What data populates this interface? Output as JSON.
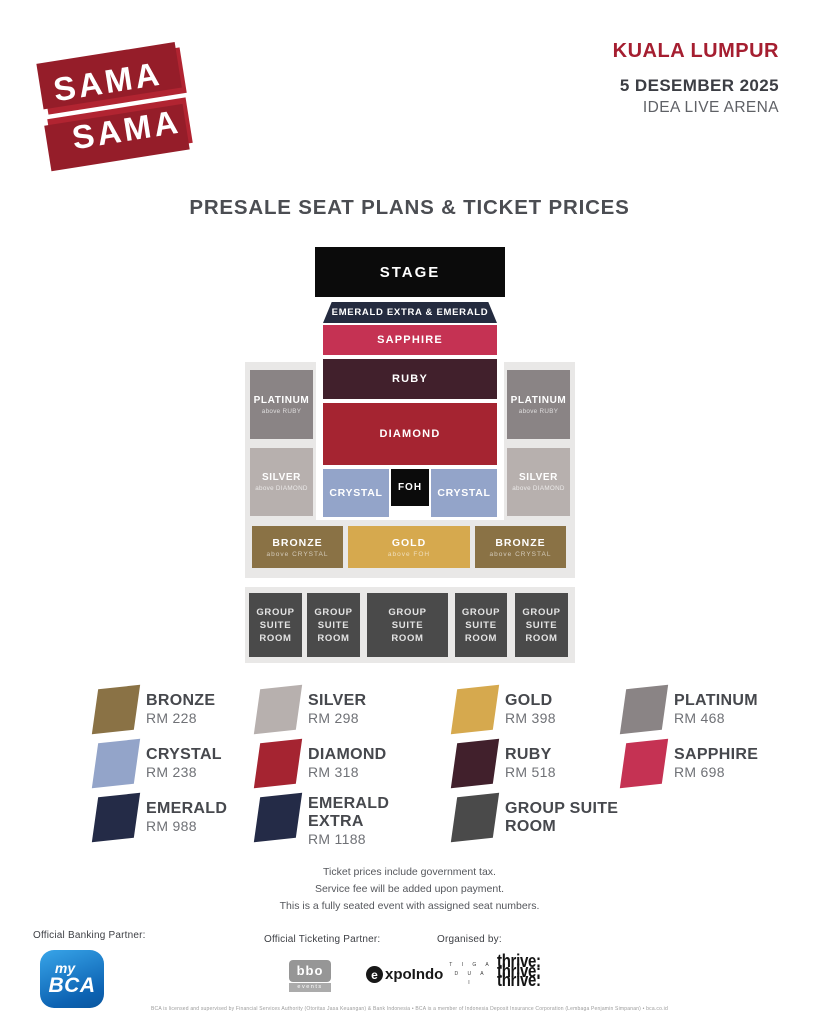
{
  "header": {
    "logo": {
      "line1": "SAMA",
      "line2": "SAMA",
      "color": "#b12431"
    },
    "city": "KUALA LUMPUR",
    "city_color": "#a51e30",
    "date": "5 DESEMBER 2025",
    "venue": "IDEA LIVE ARENA"
  },
  "title": "PRESALE SEAT PLANS & TICKET PRICES",
  "seatmap": {
    "stage": {
      "label": "STAGE",
      "color": "#0b0b0b"
    },
    "emerald_band": {
      "label": "EMERALD EXTRA & EMERALD",
      "color": "#242b3f"
    },
    "sapphire": {
      "label": "SAPPHIRE",
      "color": "#c53253"
    },
    "ruby": {
      "label": "RUBY",
      "color": "#41202c"
    },
    "diamond": {
      "label": "DIAMOND",
      "color": "#a52431"
    },
    "crystal": {
      "label": "CRYSTAL",
      "color": "#93a4c9"
    },
    "foh": {
      "label": "FOH",
      "color": "#0b0b0b"
    },
    "platinum": {
      "label": "PLATINUM",
      "sublabel": "above RUBY",
      "color": "#8a8485"
    },
    "silver": {
      "label": "SILVER",
      "sublabel": "above DIAMOND",
      "color": "#b7b0ae"
    },
    "bronze": {
      "label": "BRONZE",
      "sublabel": "above CRYSTAL",
      "color": "#8a7245"
    },
    "gold": {
      "label": "GOLD",
      "sublabel": "above FOH",
      "color": "#d6a94e"
    },
    "group_suite": {
      "label": "GROUP\nSUITE\nROOM",
      "color": "#4a4a4a"
    }
  },
  "legend": {
    "items": [
      {
        "name": "BRONZE",
        "price": "RM 228",
        "color": "#8a7245"
      },
      {
        "name": "SILVER",
        "price": "RM 298",
        "color": "#b7b0ae"
      },
      {
        "name": "GOLD",
        "price": "RM 398",
        "color": "#d6a94e"
      },
      {
        "name": "PLATINUM",
        "price": "RM 468",
        "color": "#8a8485"
      },
      {
        "name": "CRYSTAL",
        "price": "RM 238",
        "color": "#93a4c9"
      },
      {
        "name": "DIAMOND",
        "price": "RM 318",
        "color": "#a52431"
      },
      {
        "name": "RUBY",
        "price": "RM 518",
        "color": "#41202c"
      },
      {
        "name": "SAPPHIRE",
        "price": "RM 698",
        "color": "#c53253"
      },
      {
        "name": "EMERALD",
        "price": "RM 988",
        "color": "#242b47"
      },
      {
        "name": "EMERALD EXTRA",
        "price": "RM 1188",
        "color": "#242b47"
      },
      {
        "name": "GROUP SUITE ROOM",
        "price": "",
        "color": "#4a4a4a"
      }
    ]
  },
  "notes": [
    "Ticket prices include government tax.",
    "Service fee will be added upon payment.",
    "This is a fully seated event with assigned seat numbers."
  ],
  "footer": {
    "banking_label": "Official Banking Partner:",
    "ticketing_label": "Official Ticketing Partner:",
    "organised_label": "Organised by:",
    "bca": {
      "line1": "my",
      "line2": "BCA",
      "color": "#1378c5"
    },
    "bbo": {
      "line1": "bbo",
      "line2": "events"
    },
    "expoindo": {
      "initial": "e",
      "rest": "xpoIndo"
    },
    "tigadua": {
      "line1": "T I G A",
      "line2": "D U A",
      "line3": "I"
    },
    "thrive": "thrive:",
    "disclaimer": "BCA is licensed and supervised by Financial Services Authority (Otoritas Jasa Keuangan) & Bank Indonesia  •  BCA is a member of Indonesia Deposit Insurance Corporation (Lembaga Penjamin Simpanan)  •  bca.co.id"
  }
}
